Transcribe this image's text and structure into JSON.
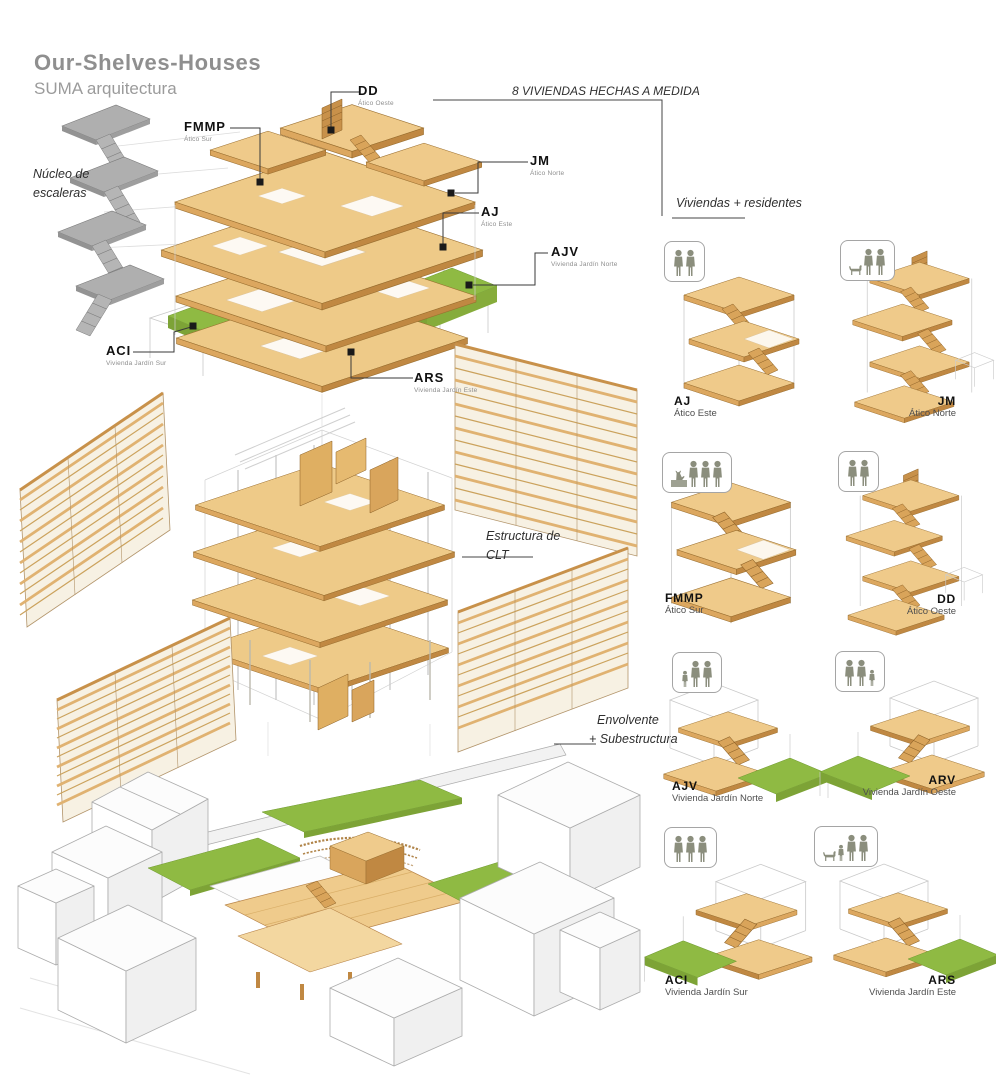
{
  "header": {
    "title": "Our-Shelves-Houses",
    "subtitle": "SUMA arquitectura"
  },
  "annotations": {
    "stair_core": "Núcleo de escaleras",
    "made_to_measure": "8 VIVIENDAS HECHAS A MEDIDA",
    "residents_heading": "Viviendas + residentes",
    "clt_structure": "Estructura de CLT",
    "envelope_line1": "Envolvente",
    "envelope_line2": "+ Subestructura"
  },
  "main_labels": [
    {
      "code": "DD",
      "sub": "Ático Oeste"
    },
    {
      "code": "FMMP",
      "sub": "Ático Sur"
    },
    {
      "code": "JM",
      "sub": "Ático Norte"
    },
    {
      "code": "AJ",
      "sub": "Ático Este"
    },
    {
      "code": "AJV",
      "sub": "Vivienda Jardín Norte"
    },
    {
      "code": "ACI",
      "sub": "Vivienda Jardín Sur"
    },
    {
      "code": "ARS",
      "sub": "Vivienda Jardín Este"
    }
  ],
  "units": [
    {
      "code": "AJ",
      "name": "Ático Este",
      "residents": [
        "adult",
        "adult"
      ],
      "garden": false
    },
    {
      "code": "JM",
      "name": "Ático Norte",
      "residents": [
        "dog",
        "adult",
        "adult"
      ],
      "garden": false
    },
    {
      "code": "FMMP",
      "name": "Ático Sur",
      "residents": [
        "cat",
        "adult",
        "adult",
        "adult"
      ],
      "garden": false
    },
    {
      "code": "DD",
      "name": "Ático Oeste",
      "residents": [
        "adult",
        "adult"
      ],
      "garden": false
    },
    {
      "code": "AJV",
      "name": "Vivienda Jardín Norte",
      "residents": [
        "child",
        "adult",
        "adult"
      ],
      "garden": true
    },
    {
      "code": "ARV",
      "name": "Vivienda Jardín Oeste",
      "residents": [
        "adult",
        "adult",
        "child"
      ],
      "garden": true
    },
    {
      "code": "ACI",
      "name": "Vivienda Jardín Sur",
      "residents": [
        "adult",
        "adult",
        "adult"
      ],
      "garden": true
    },
    {
      "code": "ARS",
      "name": "Vivienda Jardín Este",
      "residents": [
        "dog",
        "child",
        "adult",
        "adult"
      ],
      "garden": true
    }
  ],
  "colors": {
    "wood_top": "#EFCA8A",
    "wood_side": "#C08842",
    "garden_green": "#8FBA43",
    "core_gray": "#AFAFAF",
    "figure_olive": "#8B8E7D",
    "title_gray": "#8F8F8F",
    "label_black": "#111111"
  }
}
